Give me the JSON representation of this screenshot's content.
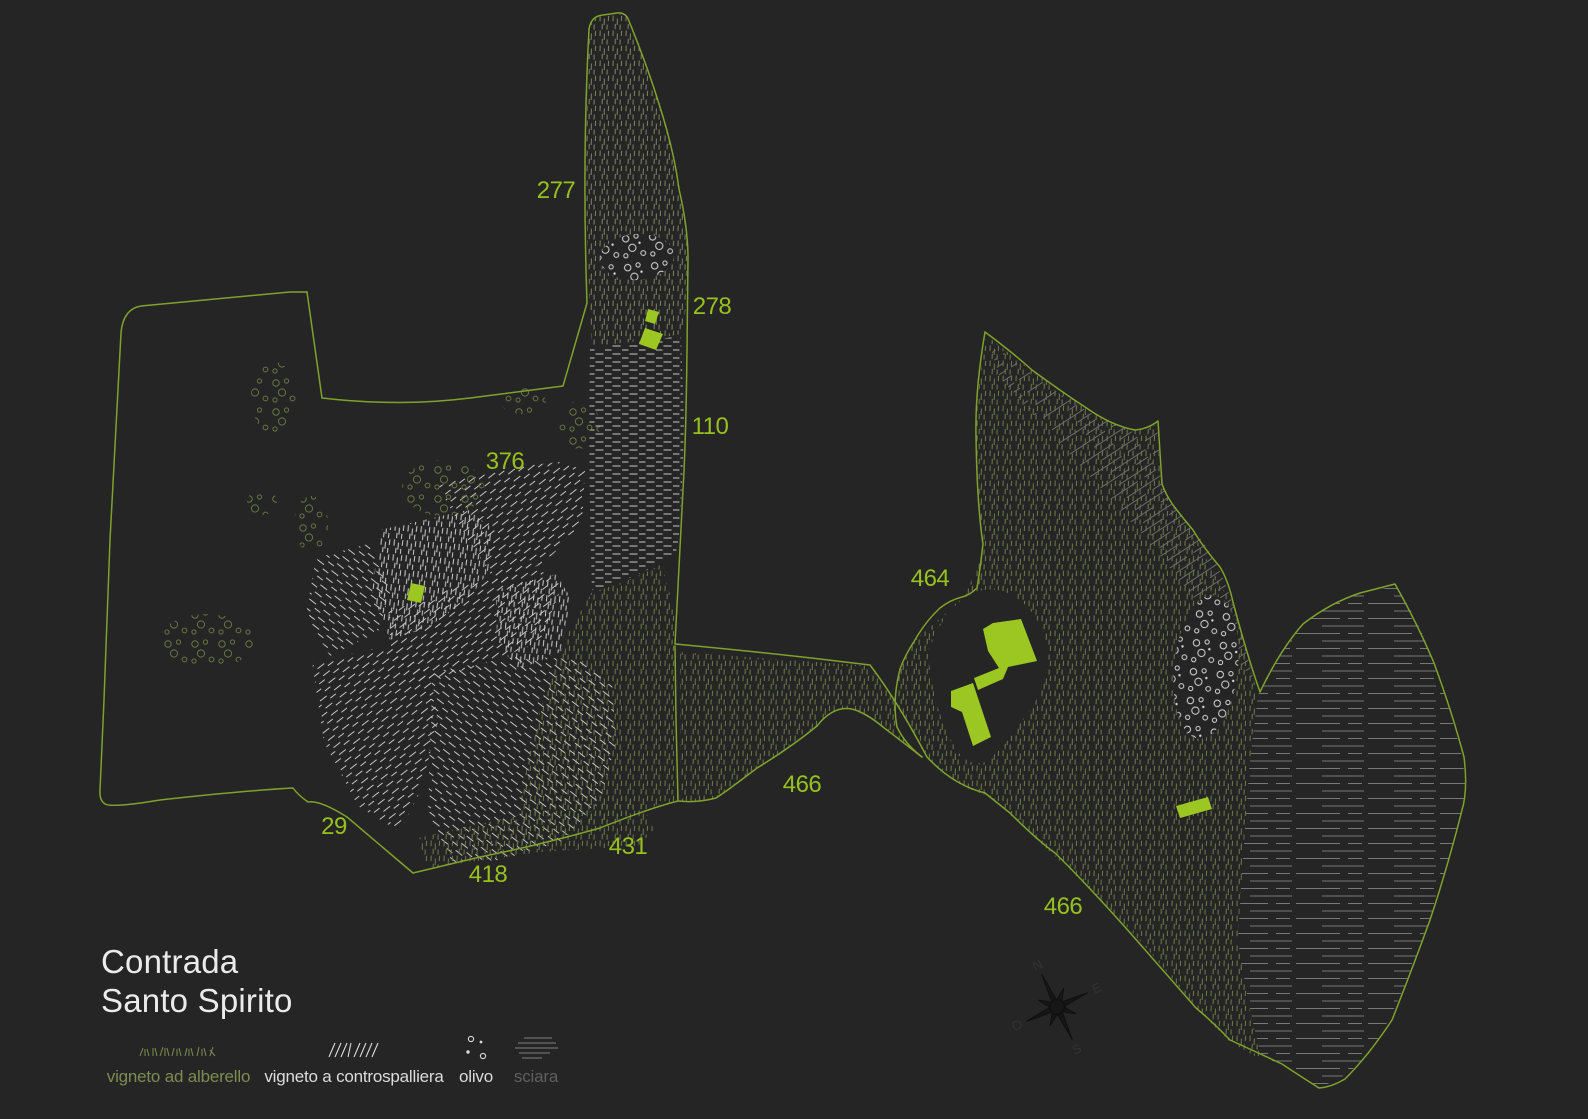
{
  "title": {
    "line1": "Contrada",
    "line2": "Santo Spirito"
  },
  "parcel_labels": [
    "277",
    "278",
    "110",
    "376",
    "464",
    "466",
    "29",
    "431",
    "418",
    "466"
  ],
  "legend": {
    "items": [
      {
        "label": "vigneto ad alberello",
        "icon": "alberello-hatch-icon",
        "color": "#7f8b50"
      },
      {
        "label": "vigneto a controspalliera",
        "icon": "controspalliera-hatch-icon",
        "color": "#dcdcdc"
      },
      {
        "label": "olivo",
        "icon": "olive-dots-icon",
        "color": "#dcdcdc"
      },
      {
        "label": "sciara",
        "icon": "sciara-lines-icon",
        "color": "#5f5f5f"
      }
    ]
  },
  "compass": {
    "n": "N",
    "e": "E",
    "s": "S",
    "w": "O"
  },
  "colors": {
    "background": "#252525",
    "label_green": "#97c11e",
    "outline_green": "#7ea32c",
    "building_green": "#9cc722",
    "alberello_olive": "#6c7748",
    "hatch_white": "#c7c7c7",
    "sciara_gray": "#787878"
  }
}
